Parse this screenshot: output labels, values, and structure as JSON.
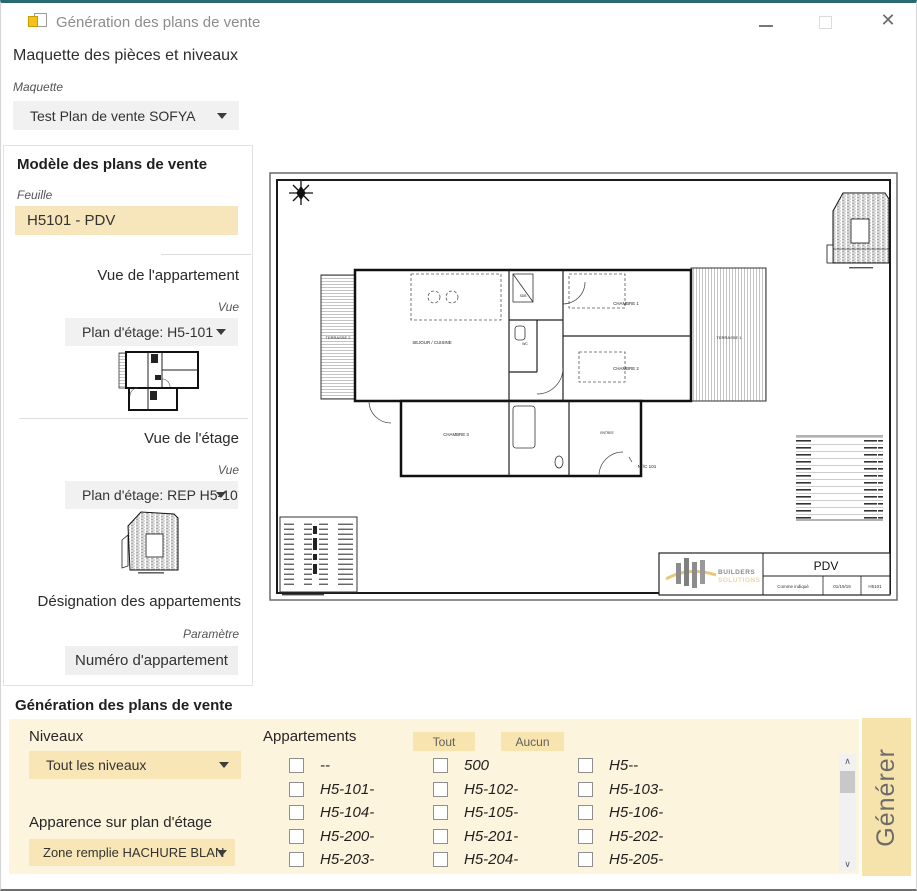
{
  "window": {
    "title": "Génération des plans de vente"
  },
  "maquette": {
    "heading": "Maquette des pièces et niveaux",
    "label": "Maquette",
    "value": "Test Plan de vente SOFYA"
  },
  "model": {
    "heading": "Modèle des plans de vente",
    "feuille_label": "Feuille",
    "feuille_value": "H5101 - PDV",
    "apartment_view": {
      "heading": "Vue de l'appartement",
      "label": "Vue",
      "value": "Plan d'étage: H5-101"
    },
    "floor_view": {
      "heading": "Vue de l'étage",
      "label": "Vue",
      "value": "Plan d'étage: REP H5-10"
    },
    "designation": {
      "heading": "Désignation des appartements",
      "label": "Paramètre",
      "value": "Numéro d'appartement"
    }
  },
  "sheet": {
    "title": "PDV",
    "scale": "Comme indiqué",
    "date": "01/19/19",
    "number": "H5101",
    "brand1": "BUILDERS",
    "brand2": "SOLUTIONS",
    "rooms": {
      "terrasse2": "TERRASSE 2",
      "sejour": "SEJOUR / CUISINE",
      "chambre1": "CHAMBRE 1",
      "chambre2": "CHAMBRE 2",
      "chambre3": "CHAMBRE 3",
      "terrasse1": "TERRASSE 1",
      "sdb": "SDB",
      "wc": "WC",
      "entree": "ENTREE",
      "tag": "N°/C 101"
    }
  },
  "generation": {
    "heading": "Génération des plans de vente",
    "niveaux_label": "Niveaux",
    "niveaux_value": "Tout les niveaux",
    "apparence_label": "Apparence sur plan d'étage",
    "apparence_value": "Zone remplie HACHURE BLAN",
    "appartements_label": "Appartements",
    "tout": "Tout",
    "aucun": "Aucun",
    "apartments": [
      "--",
      "500",
      "H5--",
      "H5-101-",
      "H5-102-",
      "H5-103-",
      "H5-104-",
      "H5-105-",
      "H5-106-",
      "H5-200-",
      "H5-201-",
      "H5-202-",
      "H5-203-",
      "H5-204-",
      "H5-205-"
    ],
    "generate": "Générer"
  },
  "colors": {
    "titlebar_accent": "#2b6a70",
    "highlight_field": "#f7e5bb",
    "panel_cream": "#fcf4dd",
    "control_cream": "#f8e6b6",
    "generate_button": "#f6e2ab",
    "logo_yellow": "#e9c873",
    "logo_gray": "#8c8c8c"
  }
}
